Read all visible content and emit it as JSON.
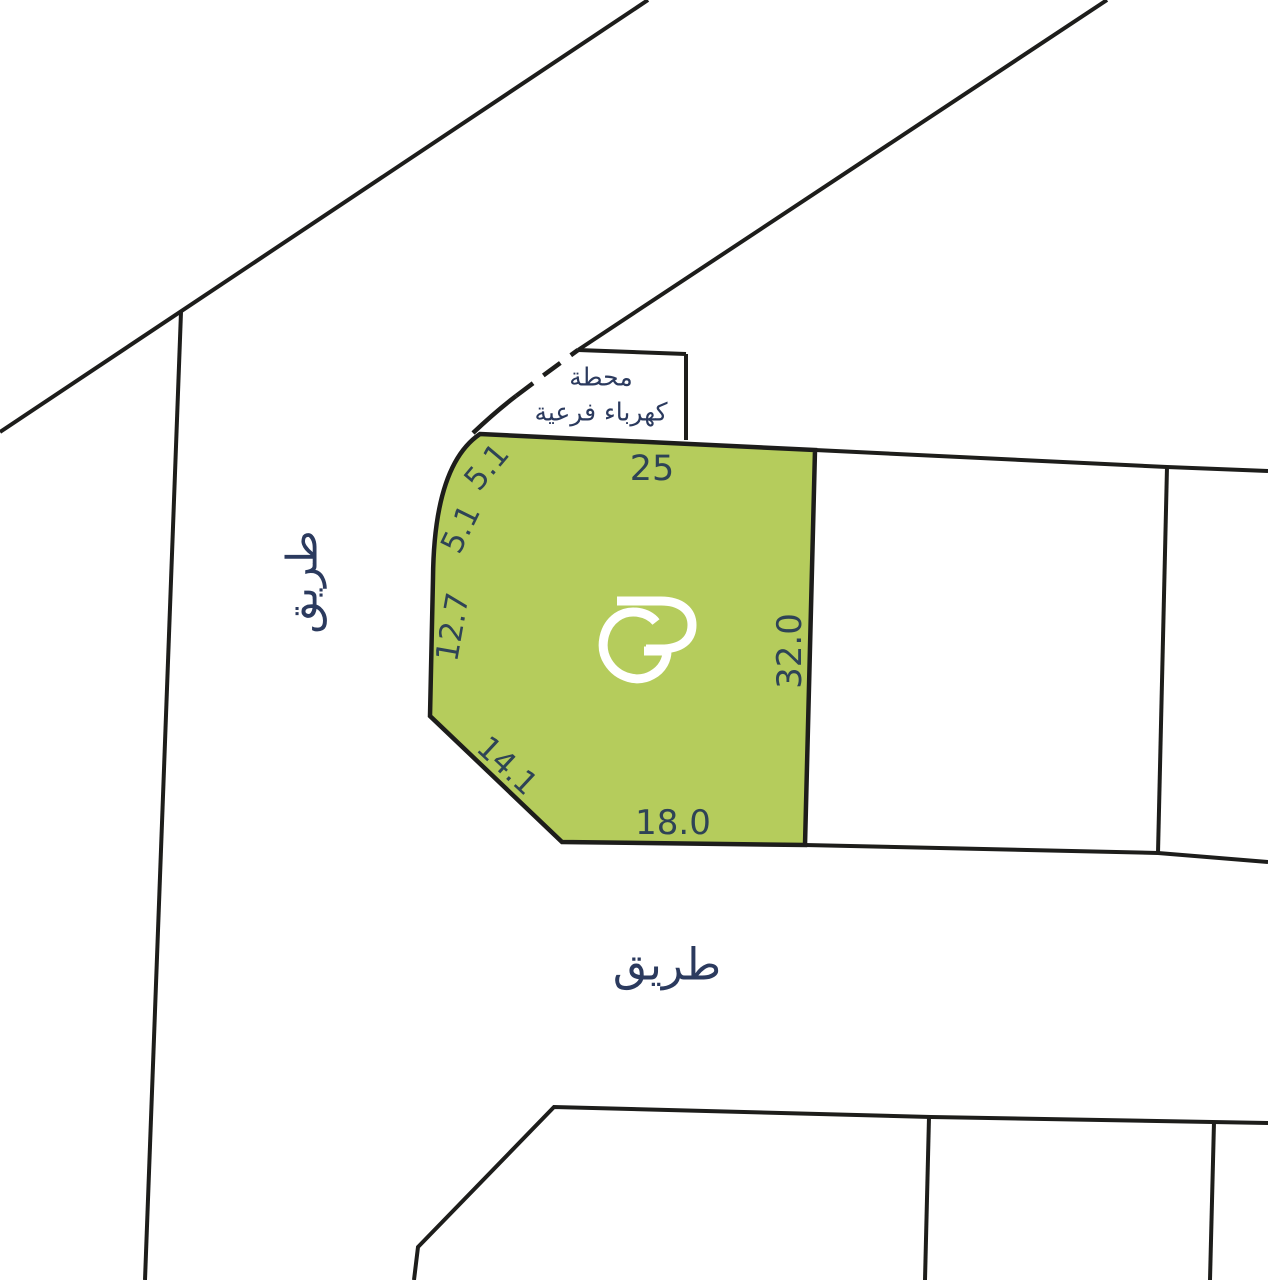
{
  "canvas": {
    "width": 1268,
    "height": 1280,
    "background": "#ffffff"
  },
  "palette": {
    "line": "#1d1d1b",
    "plot_fill": "#b5cc5c",
    "plot_stroke": "#1d1d1b",
    "arabic_text": "#2b3a5e",
    "dim_text": "#2e4356",
    "logo": "#ffffff"
  },
  "highlighted_plot": {
    "name": "highlighted-plot",
    "path": "M480,434 L815,450 L805,845 L562,842 L430,716 L433,578 Q434,465 480,434 Z",
    "stroke_width": 4.5
  },
  "boundaries": [
    {
      "name": "road-diagonal-top-left",
      "d": "M648,0 L0,432",
      "w": 4,
      "dashed": false
    },
    {
      "name": "parcel-line-left",
      "d": "M181,312 L145,1280",
      "w": 4,
      "dashed": false
    },
    {
      "name": "road-diagonal-top-right",
      "d": "M1107,0 L578,350",
      "w": 4,
      "dashed": false
    },
    {
      "name": "substation-top-edge",
      "d": "M578,350 L686,354",
      "w": 4,
      "dashed": false
    },
    {
      "name": "substation-right-edge",
      "d": "M686,354 L686,440",
      "w": 4,
      "dashed": false
    },
    {
      "name": "substation-curve-solid",
      "d": "M473,433 Q495,412 516,396",
      "w": 4.5,
      "dashed": false
    },
    {
      "name": "substation-curve-dashed",
      "d": "M516,396 Q549,371 578,350",
      "w": 4.5,
      "dashed": true
    },
    {
      "name": "right-plot-top-edge",
      "d": "M815,450 L1167,467 L1268,471",
      "w": 4,
      "dashed": false
    },
    {
      "name": "right-plot-divider",
      "d": "M1167,467 L1158,853",
      "w": 4,
      "dashed": false
    },
    {
      "name": "right-plot-bottom-edge",
      "d": "M805,845 L1158,853 L1268,862",
      "w": 4,
      "dashed": false
    },
    {
      "name": "bottom-plots-top-edge",
      "d": "M414,1280 L418,1247 L554,1107 L931,1117 L1268,1123",
      "w": 4,
      "dashed": false
    },
    {
      "name": "bottom-plot-divider-1",
      "d": "M929,1117 L925,1280",
      "w": 4,
      "dashed": false
    },
    {
      "name": "bottom-plot-divider-2",
      "d": "M1214,1122 L1210,1280",
      "w": 4,
      "dashed": false
    }
  ],
  "logo": {
    "name": "gp-logo",
    "stroke_width": 9,
    "paths": [
      "M617,601 L661,601 C681,601 692,611 692,625 C692,640 681,649 661,649 L646,649",
      "M656,622 C648,612 630,608 617,617 C603,627 599,648 608,662 C618,678 638,683 652,675 C663,669 667,659 667,651 L644,651"
    ]
  },
  "road_labels": [
    {
      "name": "road-label-left",
      "text": "طريق",
      "x": 302,
      "y": 582,
      "rotate": -90,
      "size": 42
    },
    {
      "name": "road-label-bottom",
      "text": "طريق",
      "x": 667,
      "y": 965,
      "rotate": 0,
      "size": 44
    }
  ],
  "substation_label": {
    "name": "substation-label",
    "line1": "محطة",
    "line2": "كهرباء فرعية",
    "x": 601,
    "y1": 377,
    "y2": 412,
    "size": 25
  },
  "dimension_labels": [
    {
      "name": "dim-25",
      "text": "25",
      "x": 652,
      "y": 469,
      "rotate": 0,
      "size": 35
    },
    {
      "name": "dim-5-1-a",
      "text": "5.1",
      "x": 487,
      "y": 467,
      "rotate": -50,
      "size": 31
    },
    {
      "name": "dim-5-1-b",
      "text": "5.1",
      "x": 461,
      "y": 529,
      "rotate": -64,
      "size": 31
    },
    {
      "name": "dim-12-7",
      "text": "12.7",
      "x": 453,
      "y": 627,
      "rotate": -80,
      "size": 31
    },
    {
      "name": "dim-14-1",
      "text": "14.1",
      "x": 507,
      "y": 766,
      "rotate": 43,
      "size": 31
    },
    {
      "name": "dim-18-0",
      "text": "18.0",
      "x": 673,
      "y": 823,
      "rotate": 0,
      "size": 34
    },
    {
      "name": "dim-32-0",
      "text": "32.0",
      "x": 790,
      "y": 651,
      "rotate": -90,
      "size": 34
    }
  ]
}
